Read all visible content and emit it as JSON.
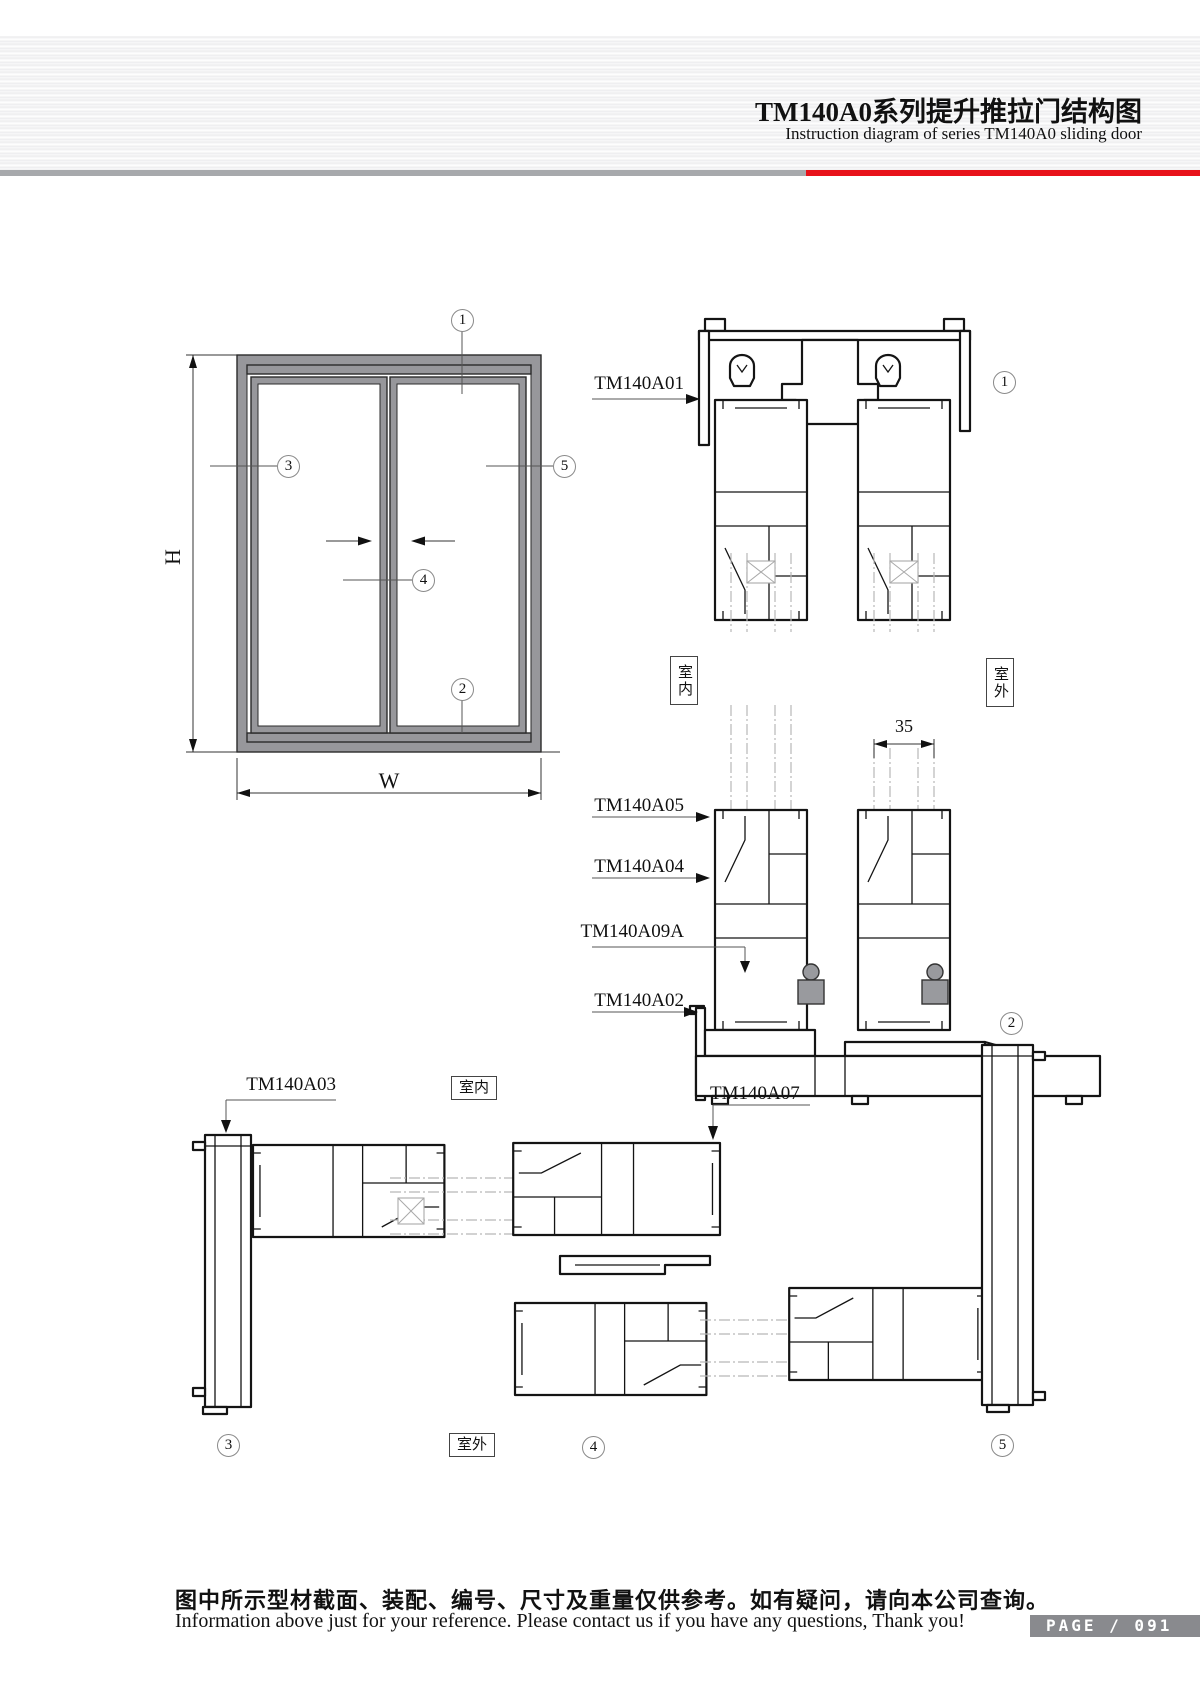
{
  "header": {
    "title_cn": "TM140A0系列提升推拉门结构图",
    "title_en": "Instruction diagram of series TM140A0 sliding door"
  },
  "elevation": {
    "h_label": "H",
    "w_label": "W"
  },
  "callouts": {
    "c1": "1",
    "c2": "2",
    "c3": "3",
    "c4": "4",
    "c5": "5"
  },
  "orientation": {
    "indoor": "室内",
    "outdoor": "室外"
  },
  "profiles": {
    "a01": "TM140A01",
    "a05": "TM140A05",
    "a04": "TM140A04",
    "a09a": "TM140A09A",
    "a02": "TM140A02",
    "a03": "TM140A03",
    "a07": "TM140A07"
  },
  "dims": {
    "glass_pocket": "35"
  },
  "footer": {
    "note_cn": "图中所示型材截面、装配、编号、尺寸及重量仅供参考。如有疑问，请向本公司查询。",
    "note_en": "Information above just for your reference. Please contact us if you have any questions, Thank you!",
    "page_label": "PAGE / 091"
  }
}
